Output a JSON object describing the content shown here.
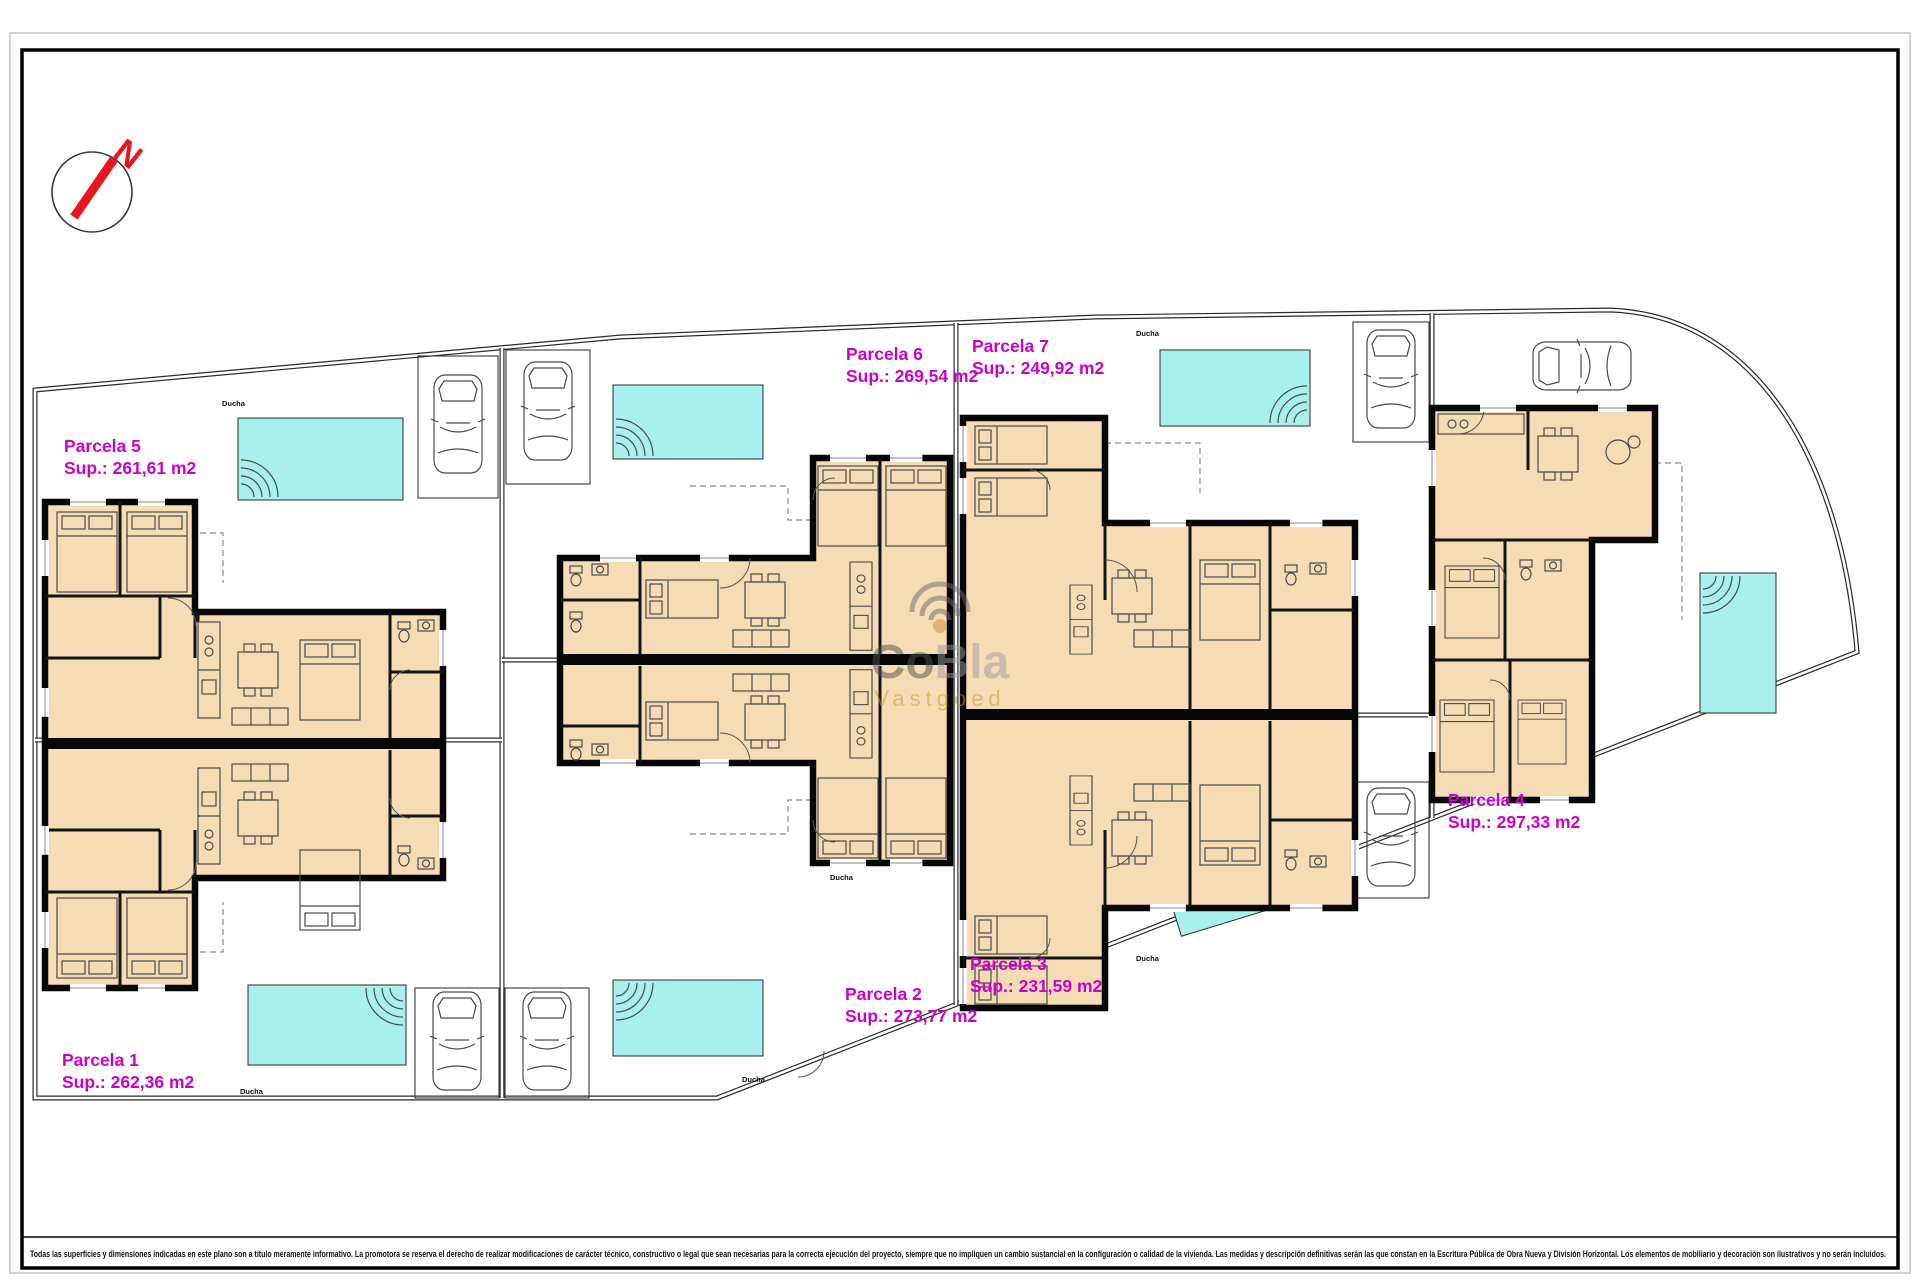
{
  "compass": {
    "north_label": "N"
  },
  "parcels": {
    "p1": {
      "name": "Parcela 1",
      "area": "Sup.: 262,36 m2"
    },
    "p2": {
      "name": "Parcela 2",
      "area": "Sup.: 273,77 m2"
    },
    "p3": {
      "name": "Parcela 3",
      "area": "Sup.: 231,59 m2"
    },
    "p4": {
      "name": "Parcela 4",
      "area": "Sup.: 297,33 m2"
    },
    "p5": {
      "name": "Parcela 5",
      "area": "Sup.: 261,61 m2"
    },
    "p6": {
      "name": "Parcela 6",
      "area": "Sup.: 269,54 m2"
    },
    "p7": {
      "name": "Parcela 7",
      "area": "Sup.: 249,92 m2"
    }
  },
  "annotations": {
    "shower": "Ducha"
  },
  "watermark": {
    "brand_part1": "Co",
    "brand_part2": "Bla",
    "tagline": "Vastgoed"
  },
  "disclaimer": "Todas las superficies y dimensiones indicadas en este plano son a título meramente informativo. La promotora se reserva el derecho de realizar modificaciones de carácter técnico, constructivo o legal que sean necesarias para la correcta ejecución del proyecto, siempre que no impliquen un cambio sustancial en la configuración o calidad de la vivienda. Las medidas y descripción definitivas serán las que constan en la Escritura Pública de Obra Nueva y División Horizontal. Los elementos de mobiliario y decoración son ilustrativos y no serán incluidos.",
  "colors": {
    "parcel_label": "#cc00cc",
    "pool": "#a8f0ec",
    "floor": "#f6dcb4",
    "north_arrow": "#e8151d",
    "wall": "#070707"
  }
}
